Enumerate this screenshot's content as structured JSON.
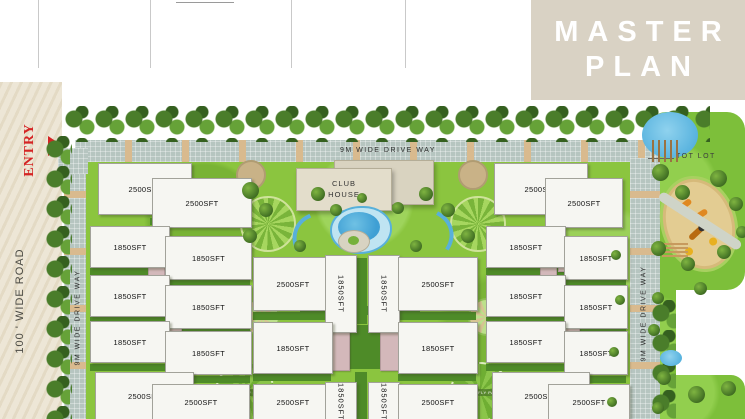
{
  "header": {
    "columns": [
      {
        "label": "PARKING AREA"
      },
      {
        "label": ""
      },
      {
        "label": "CLUB HOUSE"
      },
      {
        "label": "TOT LOT"
      }
    ]
  },
  "title": {
    "line1": "MASTER",
    "line2": "PLAN"
  },
  "road": {
    "entry_label": "ENTRY",
    "road_label": "100 ' WIDE ROAD"
  },
  "drives": {
    "top_label": "9M WIDE DRIVE WAY",
    "left_label": "9M WIDE DRIVE WAY",
    "right_label": "9M WIDE DRIVE WAY"
  },
  "amenities": {
    "club_house_line1": "CLUB",
    "club_house_line2": "HOUSE",
    "tot_lot_label": "TOT LOT",
    "butterfly_park_label": "BUTTERFLY PARK"
  },
  "colors": {
    "accent_red": "#d42424",
    "title_block": "#d9d2c4",
    "road": "#ece4d2",
    "driveway": "#b6c5c0",
    "stripe": "#d9ba8e",
    "lawn": "#8bc53f",
    "lawn_dark": "#4e8b28",
    "building": "#f6f6f2",
    "parking_pink": "#d3b8ba",
    "club_house": "#e3ddcb",
    "pool_blue": "#3f9fd4",
    "sand": "#e3cc92"
  },
  "plan": {
    "buildings": [
      {
        "x": 98,
        "y": 163,
        "w": 92,
        "h": 50,
        "label": "2500SFT"
      },
      {
        "x": 152,
        "y": 178,
        "w": 98,
        "h": 48,
        "label": "2500SFT"
      },
      {
        "x": 90,
        "y": 226,
        "w": 78,
        "h": 40,
        "label": "1850SFT"
      },
      {
        "x": 165,
        "y": 236,
        "w": 85,
        "h": 42,
        "label": "1850SFT"
      },
      {
        "x": 90,
        "y": 275,
        "w": 78,
        "h": 40,
        "label": "1850SFT"
      },
      {
        "x": 165,
        "y": 285,
        "w": 85,
        "h": 42,
        "label": "1850SFT"
      },
      {
        "x": 90,
        "y": 321,
        "w": 78,
        "h": 40,
        "label": "1850SFT"
      },
      {
        "x": 165,
        "y": 331,
        "w": 85,
        "h": 42,
        "label": "1850SFT"
      },
      {
        "x": 95,
        "y": 372,
        "w": 97,
        "h": 47,
        "label": "2500SFT"
      },
      {
        "x": 152,
        "y": 384,
        "w": 96,
        "h": 35,
        "label": "2500SFT"
      },
      {
        "x": 253,
        "y": 257,
        "w": 78,
        "h": 52,
        "label": "2500SFT"
      },
      {
        "x": 325,
        "y": 255,
        "w": 30,
        "h": 76,
        "label": "1850SFT",
        "vert": true
      },
      {
        "x": 368,
        "y": 255,
        "w": 30,
        "h": 76,
        "label": "1850SFT",
        "vert": true
      },
      {
        "x": 398,
        "y": 257,
        "w": 78,
        "h": 52,
        "label": "2500SFT"
      },
      {
        "x": 253,
        "y": 322,
        "w": 78,
        "h": 50,
        "label": "1850SFT"
      },
      {
        "x": 398,
        "y": 322,
        "w": 78,
        "h": 50,
        "label": "1850SFT"
      },
      {
        "x": 253,
        "y": 384,
        "w": 78,
        "h": 35,
        "label": "2500SFT"
      },
      {
        "x": 325,
        "y": 382,
        "w": 30,
        "h": 37,
        "label": "1850SFT",
        "vert": true
      },
      {
        "x": 368,
        "y": 382,
        "w": 30,
        "h": 37,
        "label": "1850SFT",
        "vert": true
      },
      {
        "x": 398,
        "y": 384,
        "w": 78,
        "h": 35,
        "label": "2500SFT"
      },
      {
        "x": 494,
        "y": 163,
        "w": 92,
        "h": 50,
        "label": "2500SFT"
      },
      {
        "x": 545,
        "y": 178,
        "w": 76,
        "h": 48,
        "label": "2500SFT"
      },
      {
        "x": 486,
        "y": 226,
        "w": 78,
        "h": 40,
        "label": "1850SFT"
      },
      {
        "x": 564,
        "y": 236,
        "w": 62,
        "h": 42,
        "label": "1850SFT"
      },
      {
        "x": 486,
        "y": 275,
        "w": 78,
        "h": 40,
        "label": "1850SFT"
      },
      {
        "x": 564,
        "y": 285,
        "w": 62,
        "h": 42,
        "label": "1850SFT"
      },
      {
        "x": 486,
        "y": 321,
        "w": 78,
        "h": 40,
        "label": "1850SFT"
      },
      {
        "x": 564,
        "y": 331,
        "w": 62,
        "h": 42,
        "label": "1850SFT"
      },
      {
        "x": 492,
        "y": 372,
        "w": 96,
        "h": 47,
        "label": "2500SFT"
      },
      {
        "x": 548,
        "y": 384,
        "w": 80,
        "h": 35,
        "label": "2500SFT"
      }
    ],
    "lawn_strips": [
      {
        "x": 150,
        "y": 218,
        "w": 100,
        "h": 7
      },
      {
        "x": 90,
        "y": 268,
        "w": 78,
        "h": 7
      },
      {
        "x": 165,
        "y": 280,
        "w": 85,
        "h": 7
      },
      {
        "x": 90,
        "y": 317,
        "w": 78,
        "h": 7
      },
      {
        "x": 165,
        "y": 329,
        "w": 85,
        "h": 7
      },
      {
        "x": 90,
        "y": 364,
        "w": 78,
        "h": 7
      },
      {
        "x": 165,
        "y": 376,
        "w": 85,
        "h": 7
      },
      {
        "x": 253,
        "y": 312,
        "w": 78,
        "h": 8
      },
      {
        "x": 398,
        "y": 312,
        "w": 78,
        "h": 8
      },
      {
        "x": 253,
        "y": 374,
        "w": 78,
        "h": 7
      },
      {
        "x": 398,
        "y": 374,
        "w": 78,
        "h": 7
      },
      {
        "x": 355,
        "y": 258,
        "w": 12,
        "h": 66
      },
      {
        "x": 300,
        "y": 306,
        "w": 120,
        "h": 9
      },
      {
        "x": 355,
        "y": 372,
        "w": 12,
        "h": 47
      },
      {
        "x": 348,
        "y": 325,
        "w": 32,
        "h": 44
      },
      {
        "x": 545,
        "y": 218,
        "w": 76,
        "h": 7
      },
      {
        "x": 486,
        "y": 268,
        "w": 78,
        "h": 7
      },
      {
        "x": 564,
        "y": 280,
        "w": 62,
        "h": 7
      },
      {
        "x": 486,
        "y": 317,
        "w": 78,
        "h": 7
      },
      {
        "x": 564,
        "y": 329,
        "w": 62,
        "h": 7
      },
      {
        "x": 486,
        "y": 364,
        "w": 78,
        "h": 7
      },
      {
        "x": 564,
        "y": 376,
        "w": 62,
        "h": 7
      }
    ],
    "pink_blocks": [
      {
        "x": 148,
        "y": 228,
        "w": 15,
        "h": 48
      },
      {
        "x": 168,
        "y": 242,
        "w": 13,
        "h": 28
      },
      {
        "x": 167,
        "y": 300,
        "w": 13,
        "h": 30
      },
      {
        "x": 167,
        "y": 344,
        "w": 13,
        "h": 26
      },
      {
        "x": 318,
        "y": 325,
        "w": 30,
        "h": 44
      },
      {
        "x": 380,
        "y": 325,
        "w": 30,
        "h": 44
      },
      {
        "x": 540,
        "y": 228,
        "w": 15,
        "h": 48
      },
      {
        "x": 558,
        "y": 242,
        "w": 13,
        "h": 28
      },
      {
        "x": 565,
        "y": 300,
        "w": 13,
        "h": 30
      },
      {
        "x": 565,
        "y": 344,
        "w": 13,
        "h": 26
      }
    ],
    "trees": [
      [
        250,
        190,
        17
      ],
      [
        266,
        210,
        14
      ],
      [
        250,
        236,
        14
      ],
      [
        318,
        194,
        14
      ],
      [
        336,
        210,
        12
      ],
      [
        300,
        246,
        12
      ],
      [
        398,
        208,
        12
      ],
      [
        426,
        194,
        14
      ],
      [
        448,
        210,
        14
      ],
      [
        468,
        236,
        14
      ],
      [
        416,
        246,
        12
      ],
      [
        362,
        198,
        10
      ],
      [
        660,
        172,
        17
      ],
      [
        682,
        192,
        15
      ],
      [
        718,
        178,
        17
      ],
      [
        736,
        204,
        14
      ],
      [
        742,
        232,
        12
      ],
      [
        658,
        248,
        15
      ],
      [
        688,
        264,
        14
      ],
      [
        724,
        252,
        14
      ],
      [
        700,
        288,
        13
      ],
      [
        658,
        298,
        12
      ],
      [
        654,
        330,
        12
      ],
      [
        664,
        378,
        14
      ],
      [
        696,
        394,
        17
      ],
      [
        728,
        388,
        15
      ],
      [
        658,
        408,
        12
      ],
      [
        620,
        300,
        10
      ],
      [
        616,
        255,
        10
      ],
      [
        614,
        352,
        10
      ],
      [
        612,
        402,
        10
      ]
    ]
  }
}
